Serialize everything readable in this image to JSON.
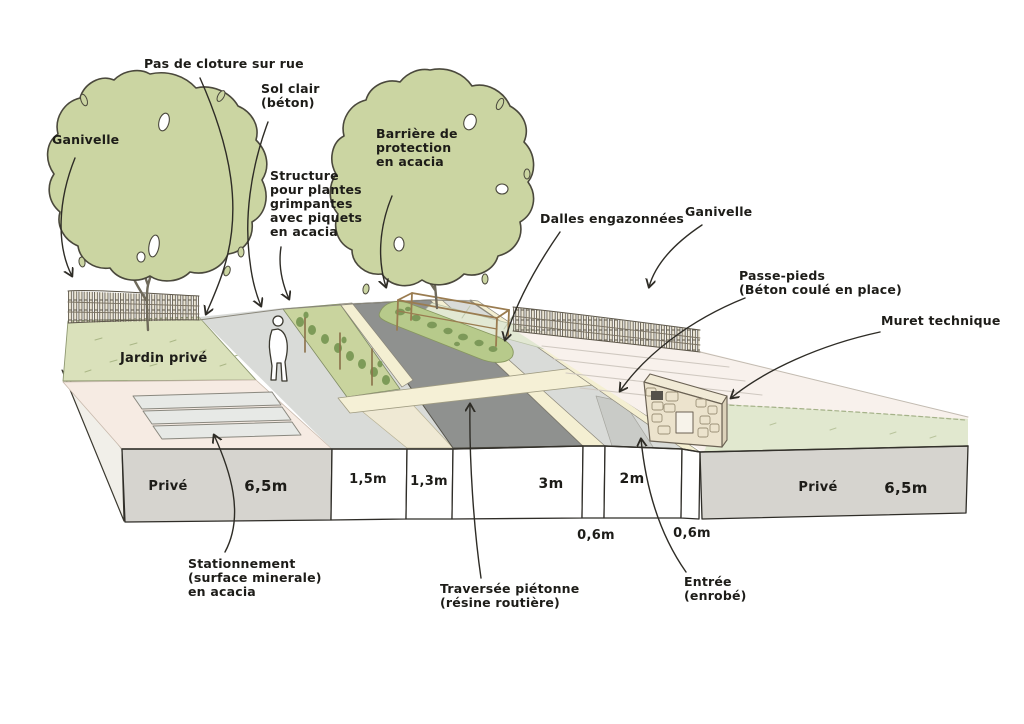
{
  "figure_type": "hand-drawn landscape street cross-section sketch",
  "labels": {
    "ganivelle_left": "Ganivelle",
    "pas_de_cloture": "Pas de cloture sur rue",
    "sol_clair": {
      "l1": "Sol clair",
      "l2": "(béton)"
    },
    "structure_plantes": {
      "l1": "Structure",
      "l2": "pour plantes",
      "l3": "grimpantes",
      "l4": "avec piquets",
      "l5": "en acacia"
    },
    "barriere": {
      "l1": "Barrière de",
      "l2": "protection",
      "l3": "en acacia"
    },
    "dalles": "Dalles engazonnées",
    "ganivelle_right": "Ganivelle",
    "passe_pieds": {
      "l1": "Passe-pieds",
      "l2": "(Béton coulé en place)"
    },
    "muret": "Muret technique",
    "jardin_prive": "Jardin privé",
    "stationnement": {
      "l1": "Stationnement",
      "l2": "(surface minerale)",
      "l3": "en acacia"
    },
    "traversee": {
      "l1": "Traversée piétonne",
      "l2": "(résine routière)"
    },
    "entree": {
      "l1": "Entrée",
      "l2": "(enrobé)"
    }
  },
  "measurements": {
    "left_parcel": {
      "owner": "Privé",
      "width": "6,5m"
    },
    "footpath_width": "1,5m",
    "planting_strip_width": "1,3m",
    "road_width": "3m",
    "passe_pieds_width": "2m",
    "edge_band_left": "0,6m",
    "edge_band_right": "0,6m",
    "right_parcel": {
      "owner": "Privé",
      "width": "6,5m"
    }
  },
  "colors": {
    "foliage": "#cbd5a2",
    "lawn_left": "#dae1bb",
    "lawn_right": "#e1e8cf",
    "hedge_strip": "#c9d49e",
    "tree_mound": "#b7ca8b",
    "grass_pavers": "#e2e8d3",
    "road": "#8f918f",
    "footpath": "#d9dbd8",
    "cream_band": "#f4efd2",
    "pink_ground": "#f6ebe3",
    "face_grey": "#d6d4cf",
    "wood": "#9a7c50",
    "outline": "#33312b"
  }
}
